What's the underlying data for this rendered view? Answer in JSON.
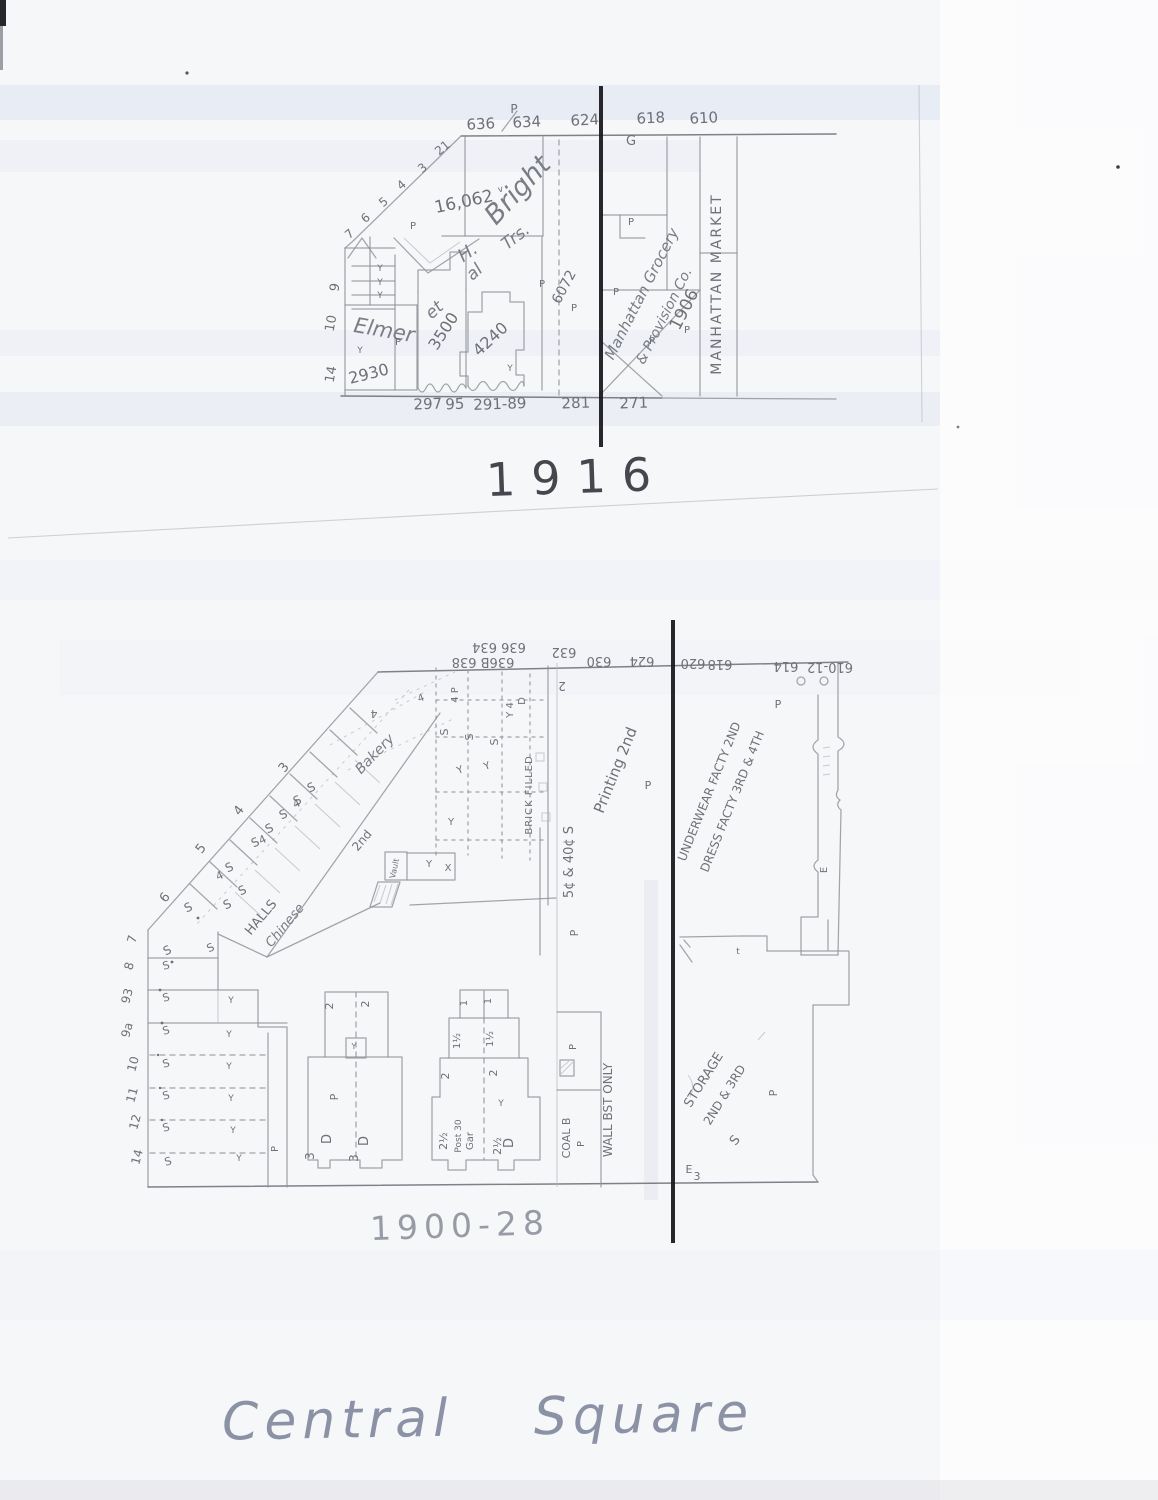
{
  "page": {
    "captions": {
      "map1_year": "1916",
      "map2_year": "1900-28",
      "title": "Central Square"
    }
  },
  "map_1916": {
    "labels": [
      {
        "t": "636",
        "x": 481,
        "y": 129,
        "r": -3,
        "s": 15,
        "c": "#4e4f57"
      },
      {
        "t": "634",
        "x": 527,
        "y": 127,
        "r": -3,
        "s": 15,
        "c": "#4e4f57"
      },
      {
        "t": "624",
        "x": 585,
        "y": 125,
        "r": -3,
        "s": 15,
        "c": "#4e4f57"
      },
      {
        "t": "618",
        "x": 651,
        "y": 123,
        "r": -3,
        "s": 15,
        "c": "#4e4f57"
      },
      {
        "t": "610",
        "x": 704,
        "y": 123,
        "r": -3,
        "s": 15,
        "c": "#4e4f57"
      },
      {
        "t": "P",
        "x": 514,
        "y": 113,
        "s": 12
      },
      {
        "t": "21",
        "x": 445,
        "y": 151,
        "r": -40,
        "s": 12
      },
      {
        "t": "3",
        "x": 425,
        "y": 171,
        "r": -40,
        "s": 12
      },
      {
        "t": "4",
        "x": 404,
        "y": 188,
        "r": -40,
        "s": 12
      },
      {
        "t": "5",
        "x": 386,
        "y": 205,
        "r": -40,
        "s": 12
      },
      {
        "t": "6",
        "x": 368,
        "y": 221,
        "r": -40,
        "s": 12
      },
      {
        "t": "7",
        "x": 352,
        "y": 237,
        "r": -40,
        "s": 12
      },
      {
        "t": "9",
        "x": 339,
        "y": 288,
        "r": -80,
        "s": 13
      },
      {
        "t": "10",
        "x": 335,
        "y": 324,
        "r": -80,
        "s": 13
      },
      {
        "t": "14",
        "x": 335,
        "y": 375,
        "r": -80,
        "s": 13
      },
      {
        "t": "16,062",
        "x": 465,
        "y": 207,
        "r": -12,
        "s": 17
      },
      {
        "t": "v",
        "x": 501,
        "y": 192,
        "r": -12,
        "s": 9
      },
      {
        "t": "Elmer",
        "x": 383,
        "y": 337,
        "r": 10,
        "s": 21,
        "i": 1
      },
      {
        "t": "H.",
        "x": 471,
        "y": 257,
        "r": -35,
        "s": 18,
        "i": 1
      },
      {
        "t": "Bright",
        "x": 524,
        "y": 196,
        "r": -47,
        "s": 27,
        "i": 1
      },
      {
        "t": "et",
        "x": 438,
        "y": 314,
        "r": -42,
        "s": 17,
        "i": 1
      },
      {
        "t": "al",
        "x": 478,
        "y": 276,
        "r": -42,
        "s": 17,
        "i": 1
      },
      {
        "t": "Trs.",
        "x": 519,
        "y": 241,
        "r": -38,
        "s": 17,
        "i": 1
      },
      {
        "t": "2930",
        "x": 370,
        "y": 379,
        "r": -14,
        "s": 16
      },
      {
        "t": "3500",
        "x": 448,
        "y": 334,
        "r": -57,
        "s": 16
      },
      {
        "t": "4240",
        "x": 494,
        "y": 343,
        "r": -43,
        "s": 16
      },
      {
        "t": "6072",
        "x": 568,
        "y": 289,
        "r": -62,
        "s": 14
      },
      {
        "t": "Y",
        "x": 380,
        "y": 271,
        "s": 9
      },
      {
        "t": "Y",
        "x": 380,
        "y": 285,
        "s": 9
      },
      {
        "t": "Y",
        "x": 380,
        "y": 298,
        "s": 9
      },
      {
        "t": "Y",
        "x": 360,
        "y": 353,
        "s": 9
      },
      {
        "t": "Y",
        "x": 510,
        "y": 371,
        "s": 9
      },
      {
        "t": "P",
        "x": 413,
        "y": 229,
        "s": 10
      },
      {
        "t": "P",
        "x": 398,
        "y": 345,
        "s": 10
      },
      {
        "t": "P",
        "x": 542,
        "y": 287,
        "s": 10
      },
      {
        "t": "P",
        "x": 574,
        "y": 311,
        "s": 10
      },
      {
        "t": "P",
        "x": 631,
        "y": 225,
        "s": 10
      },
      {
        "t": "P",
        "x": 616,
        "y": 295,
        "s": 10
      },
      {
        "t": "P",
        "x": 652,
        "y": 344,
        "s": 10
      },
      {
        "t": "P",
        "x": 687,
        "y": 333,
        "s": 10
      },
      {
        "t": "G",
        "x": 631,
        "y": 145,
        "s": 13
      },
      {
        "t": "Manhattan Grocery",
        "x": 646,
        "y": 296,
        "r": -63,
        "s": 15,
        "i": 1
      },
      {
        "t": "& Provision Co.",
        "x": 668,
        "y": 318,
        "r": -63,
        "s": 14,
        "i": 1
      },
      {
        "t": "1906",
        "x": 689,
        "y": 312,
        "r": -63,
        "s": 17
      },
      {
        "t": "MANHATTAN MARKET",
        "x": 721,
        "y": 284,
        "r": -90,
        "s": 14,
        "ls": 2
      },
      {
        "t": "297",
        "x": 428,
        "y": 409,
        "r": -2,
        "s": 15,
        "c": "#4e4f57"
      },
      {
        "t": "95",
        "x": 455,
        "y": 409,
        "r": -2,
        "s": 15,
        "c": "#4e4f57"
      },
      {
        "t": "291-89",
        "x": 500,
        "y": 409,
        "r": -2,
        "s": 15,
        "c": "#4e4f57"
      },
      {
        "t": "281",
        "x": 576,
        "y": 408,
        "r": -2,
        "s": 15,
        "c": "#4e4f57"
      },
      {
        "t": "271",
        "x": 634,
        "y": 408,
        "r": -2,
        "s": 15,
        "c": "#4e4f57"
      }
    ]
  },
  "map_1900_28": {
    "labels": [
      {
        "t": "636 634",
        "x": 499,
        "y": 643,
        "r": 180,
        "s": 13,
        "c": "#54555d"
      },
      {
        "t": "632",
        "x": 564,
        "y": 648,
        "r": 180,
        "s": 13,
        "c": "#54555d"
      },
      {
        "t": "636B 638",
        "x": 483,
        "y": 658,
        "r": 180,
        "s": 13,
        "c": "#54555d"
      },
      {
        "t": "630",
        "x": 599,
        "y": 657,
        "r": 180,
        "s": 13,
        "c": "#54555d"
      },
      {
        "t": "624",
        "x": 642,
        "y": 657,
        "r": 180,
        "s": 13,
        "c": "#54555d"
      },
      {
        "t": "620",
        "x": 693,
        "y": 659,
        "r": 180,
        "s": 13,
        "c": "#54555d"
      },
      {
        "t": "618",
        "x": 720,
        "y": 660,
        "r": 180,
        "s": 13,
        "c": "#54555d"
      },
      {
        "t": "614",
        "x": 786,
        "y": 662,
        "r": 180,
        "s": 13,
        "c": "#54555d"
      },
      {
        "t": "610-12",
        "x": 830,
        "y": 663,
        "r": 180,
        "s": 13,
        "c": "#54555d"
      },
      {
        "t": "2",
        "x": 562,
        "y": 682,
        "r": 180,
        "s": 12
      },
      {
        "t": "7",
        "x": 136,
        "y": 940,
        "r": -75,
        "s": 12
      },
      {
        "t": "8",
        "x": 133,
        "y": 967,
        "r": -75,
        "s": 12
      },
      {
        "t": "93",
        "x": 131,
        "y": 997,
        "r": -75,
        "s": 12
      },
      {
        "t": "9a",
        "x": 131,
        "y": 1031,
        "r": -75,
        "s": 12
      },
      {
        "t": "10",
        "x": 137,
        "y": 1065,
        "r": -75,
        "s": 12
      },
      {
        "t": "11",
        "x": 136,
        "y": 1096,
        "r": -75,
        "s": 12
      },
      {
        "t": "12",
        "x": 139,
        "y": 1123,
        "r": -75,
        "s": 12
      },
      {
        "t": "14",
        "x": 141,
        "y": 1158,
        "r": -75,
        "s": 12
      },
      {
        "t": "3",
        "x": 287,
        "y": 770,
        "r": -52,
        "s": 13
      },
      {
        "t": "4",
        "x": 242,
        "y": 813,
        "r": -52,
        "s": 13
      },
      {
        "t": "5",
        "x": 204,
        "y": 851,
        "r": -52,
        "s": 13
      },
      {
        "t": "6",
        "x": 168,
        "y": 900,
        "r": -52,
        "s": 13
      },
      {
        "t": "4",
        "x": 298,
        "y": 807,
        "r": -25,
        "s": 11
      },
      {
        "t": "4",
        "x": 264,
        "y": 843,
        "r": -25,
        "s": 11
      },
      {
        "t": "4",
        "x": 221,
        "y": 879,
        "r": -25,
        "s": 11
      },
      {
        "t": "S",
        "x": 313,
        "y": 791,
        "r": -25,
        "s": 12
      },
      {
        "t": "S",
        "x": 299,
        "y": 804,
        "r": -25,
        "s": 12
      },
      {
        "t": "S",
        "x": 285,
        "y": 818,
        "r": -25,
        "s": 12
      },
      {
        "t": "S",
        "x": 271,
        "y": 832,
        "r": -25,
        "s": 12
      },
      {
        "t": "S",
        "x": 257,
        "y": 846,
        "r": -25,
        "s": 12
      },
      {
        "t": "S",
        "x": 231,
        "y": 871,
        "r": -25,
        "s": 12
      },
      {
        "t": "S",
        "x": 244,
        "y": 894,
        "r": -25,
        "s": 12
      },
      {
        "t": "S",
        "x": 229,
        "y": 908,
        "r": -25,
        "s": 12
      },
      {
        "t": "S",
        "x": 190,
        "y": 911,
        "r": -25,
        "s": 12
      },
      {
        "t": "S",
        "x": 169,
        "y": 954,
        "r": -25,
        "s": 12
      },
      {
        "t": "S",
        "x": 212,
        "y": 951,
        "r": -25,
        "s": 11
      },
      {
        "t": "HALLS",
        "x": 264,
        "y": 920,
        "r": -50,
        "s": 13
      },
      {
        "t": "Chinese",
        "x": 288,
        "y": 928,
        "r": -50,
        "s": 13,
        "i": 1
      },
      {
        "t": "2nd",
        "x": 365,
        "y": 843,
        "r": -50,
        "s": 12
      },
      {
        "t": "Bakery",
        "x": 378,
        "y": 757,
        "r": -46,
        "s": 14,
        "i": 1
      },
      {
        "t": "4",
        "x": 374,
        "y": 710,
        "r": 180,
        "s": 11
      },
      {
        "t": "4",
        "x": 422,
        "y": 701,
        "r": -20,
        "s": 10
      },
      {
        "t": "4 P",
        "x": 458,
        "y": 695,
        "r": -90,
        "s": 10
      },
      {
        "t": "S",
        "x": 448,
        "y": 732,
        "r": -90,
        "s": 11
      },
      {
        "t": "S",
        "x": 473,
        "y": 737,
        "r": -90,
        "s": 11
      },
      {
        "t": "S",
        "x": 498,
        "y": 742,
        "r": -90,
        "s": 11
      },
      {
        "t": "Y 4",
        "x": 513,
        "y": 710,
        "r": -90,
        "s": 10
      },
      {
        "t": "D",
        "x": 525,
        "y": 701,
        "r": -90,
        "s": 10
      },
      {
        "t": "Y",
        "x": 488,
        "y": 769,
        "r": -20,
        "s": 10
      },
      {
        "t": "Y",
        "x": 461,
        "y": 773,
        "r": -20,
        "s": 10
      },
      {
        "t": "BRICK FILLED",
        "x": 532,
        "y": 795,
        "r": -90,
        "s": 10,
        "ls": 1
      },
      {
        "t": "Vault",
        "x": 397,
        "y": 869,
        "r": -78,
        "s": 8
      },
      {
        "t": "Y",
        "x": 429,
        "y": 867,
        "s": 10
      },
      {
        "t": "X",
        "x": 448,
        "y": 871,
        "s": 10
      },
      {
        "t": "Y",
        "x": 451,
        "y": 825,
        "s": 10
      },
      {
        "t": "5¢ & 40¢ S",
        "x": 573,
        "y": 862,
        "r": -90,
        "s": 13
      },
      {
        "t": "Printing 2nd",
        "x": 620,
        "y": 772,
        "r": -68,
        "s": 15
      },
      {
        "t": "P",
        "x": 648,
        "y": 789,
        "s": 11
      },
      {
        "t": "P",
        "x": 578,
        "y": 933,
        "r": -90,
        "s": 11
      },
      {
        "t": "UNDERWEAR FACTY 2ND",
        "x": 713,
        "y": 793,
        "r": -68,
        "s": 12
      },
      {
        "t": "DRESS FACTY 3RD & 4TH",
        "x": 736,
        "y": 803,
        "r": -68,
        "s": 12
      },
      {
        "t": "P",
        "x": 778,
        "y": 708,
        "s": 11
      },
      {
        "t": "E",
        "x": 827,
        "y": 870,
        "r": -90,
        "s": 10
      },
      {
        "t": "t",
        "x": 738,
        "y": 954,
        "s": 9
      },
      {
        "t": "STORAGE",
        "x": 707,
        "y": 1082,
        "r": -58,
        "s": 13
      },
      {
        "t": "2ND & 3RD",
        "x": 728,
        "y": 1097,
        "r": -58,
        "s": 12
      },
      {
        "t": "S",
        "x": 738,
        "y": 1143,
        "r": -50,
        "s": 13
      },
      {
        "t": "E",
        "x": 689,
        "y": 1173,
        "s": 11
      },
      {
        "t": "3",
        "x": 697,
        "y": 1180,
        "s": 11
      },
      {
        "t": "P",
        "x": 777,
        "y": 1093,
        "r": -90,
        "s": 11
      },
      {
        "t": "2",
        "x": 333,
        "y": 1006,
        "r": -90,
        "s": 11
      },
      {
        "t": "2",
        "x": 369,
        "y": 1004,
        "r": -90,
        "s": 11
      },
      {
        "t": "Y",
        "x": 354,
        "y": 1049,
        "s": 8
      },
      {
        "t": "P",
        "x": 338,
        "y": 1097,
        "r": -90,
        "s": 11
      },
      {
        "t": "D",
        "x": 331,
        "y": 1139,
        "r": -90,
        "s": 13
      },
      {
        "t": "D",
        "x": 368,
        "y": 1141,
        "r": -90,
        "s": 13
      },
      {
        "t": "3",
        "x": 314,
        "y": 1156,
        "r": -90,
        "s": 12
      },
      {
        "t": "3",
        "x": 358,
        "y": 1158,
        "r": -90,
        "s": 12
      },
      {
        "t": "1",
        "x": 467,
        "y": 1003,
        "r": -90,
        "s": 10
      },
      {
        "t": "1",
        "x": 491,
        "y": 1001,
        "r": -90,
        "s": 10
      },
      {
        "t": "1½",
        "x": 460,
        "y": 1041,
        "r": -90,
        "s": 10
      },
      {
        "t": "1½",
        "x": 493,
        "y": 1039,
        "r": -90,
        "s": 10
      },
      {
        "t": "2",
        "x": 449,
        "y": 1076,
        "r": -90,
        "s": 11
      },
      {
        "t": "2",
        "x": 497,
        "y": 1073,
        "r": -90,
        "s": 11
      },
      {
        "t": "2½",
        "x": 447,
        "y": 1141,
        "r": -90,
        "s": 11
      },
      {
        "t": "Post 30",
        "x": 461,
        "y": 1136,
        "r": -90,
        "s": 9
      },
      {
        "t": "Gar",
        "x": 473,
        "y": 1141,
        "r": -90,
        "s": 10
      },
      {
        "t": "2½",
        "x": 501,
        "y": 1146,
        "r": -90,
        "s": 11
      },
      {
        "t": "D",
        "x": 513,
        "y": 1143,
        "r": -90,
        "s": 13
      },
      {
        "t": "Y",
        "x": 501,
        "y": 1106,
        "s": 9
      },
      {
        "t": "P",
        "x": 576,
        "y": 1047,
        "r": -90,
        "s": 10
      },
      {
        "t": "COAL B",
        "x": 570,
        "y": 1138,
        "r": -90,
        "s": 11
      },
      {
        "t": "P",
        "x": 584,
        "y": 1144,
        "r": -90,
        "s": 10
      },
      {
        "t": "WALL BST ONLY",
        "x": 612,
        "y": 1110,
        "r": -90,
        "s": 12
      },
      {
        "t": "S",
        "x": 167,
        "y": 969,
        "r": -15,
        "s": 11
      },
      {
        "t": "S",
        "x": 167,
        "y": 1001,
        "r": -15,
        "s": 11
      },
      {
        "t": "S",
        "x": 167,
        "y": 1034,
        "r": -15,
        "s": 11
      },
      {
        "t": "S",
        "x": 167,
        "y": 1067,
        "r": -15,
        "s": 11
      },
      {
        "t": "S",
        "x": 167,
        "y": 1099,
        "r": -15,
        "s": 11
      },
      {
        "t": "S",
        "x": 167,
        "y": 1131,
        "r": -15,
        "s": 11
      },
      {
        "t": "S",
        "x": 169,
        "y": 1165,
        "r": -15,
        "s": 11
      },
      {
        "t": "Y",
        "x": 231,
        "y": 1003,
        "s": 9
      },
      {
        "t": "Y",
        "x": 229,
        "y": 1037,
        "s": 9
      },
      {
        "t": "Y",
        "x": 229,
        "y": 1069,
        "s": 9
      },
      {
        "t": "Y",
        "x": 231,
        "y": 1101,
        "s": 9
      },
      {
        "t": "Y",
        "x": 233,
        "y": 1133,
        "s": 9
      },
      {
        "t": "Y",
        "x": 239,
        "y": 1161,
        "s": 9
      },
      {
        "t": "P",
        "x": 278,
        "y": 1149,
        "r": -90,
        "s": 10
      }
    ]
  }
}
